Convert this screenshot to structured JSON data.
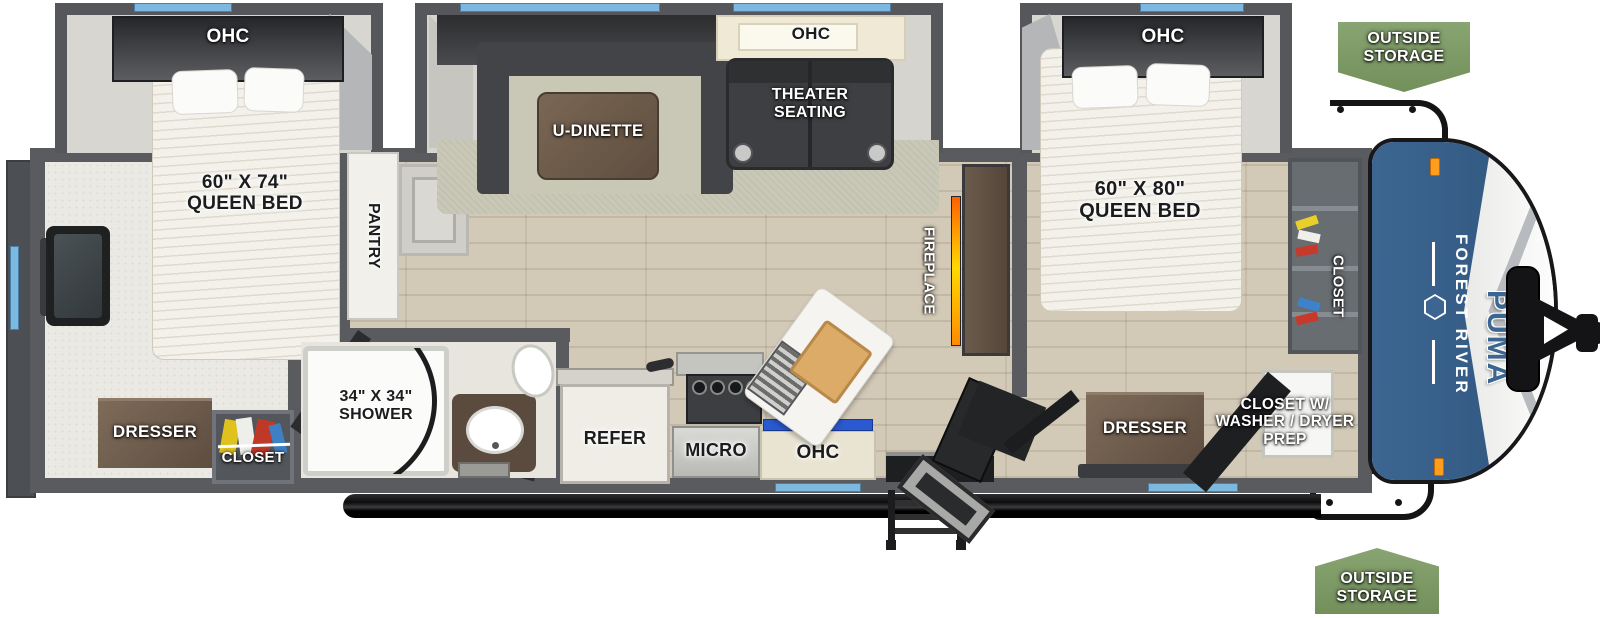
{
  "brand": {
    "manufacturer": "FOREST RIVER",
    "model": "PUMA"
  },
  "exterior": {
    "outside_storage_front": "OUTSIDE\nSTORAGE",
    "outside_storage_rear": "OUTSIDE\nSTORAGE"
  },
  "rear_bedroom": {
    "ohc": "OHC",
    "bed": "60\" X 74\"\nQUEEN BED",
    "dresser": "DRESSER",
    "closet": "CLOSET"
  },
  "hall": {
    "pantry": "PANTRY"
  },
  "bathroom": {
    "shower": "34\" X 34\"\nSHOWER"
  },
  "kitchen": {
    "refrigerator": "REFER",
    "microwave": "MICRO",
    "ohc": "OHC"
  },
  "living_room": {
    "dinette": "U-DINETTE",
    "theater_seating": "THEATER\nSEATING",
    "ohc": "OHC",
    "fireplace": "FIREPLACE"
  },
  "front_bedroom": {
    "ohc": "OHC",
    "bed": "60\" X 80\"\nQUEEN BED",
    "dresser": "DRESSER",
    "wardrobe": "CLOSET",
    "closet_washer_dryer": "CLOSET W/\nWASHER / DRYER\nPREP"
  },
  "colors": {
    "wall_gray": "#595b5f",
    "window_blue": "#7db8e0",
    "storage_green": "#7e9c68",
    "cap_blue": "#3c6691",
    "flame_orange": "#ff6a00",
    "counter_blue": "#2b59cf"
  }
}
